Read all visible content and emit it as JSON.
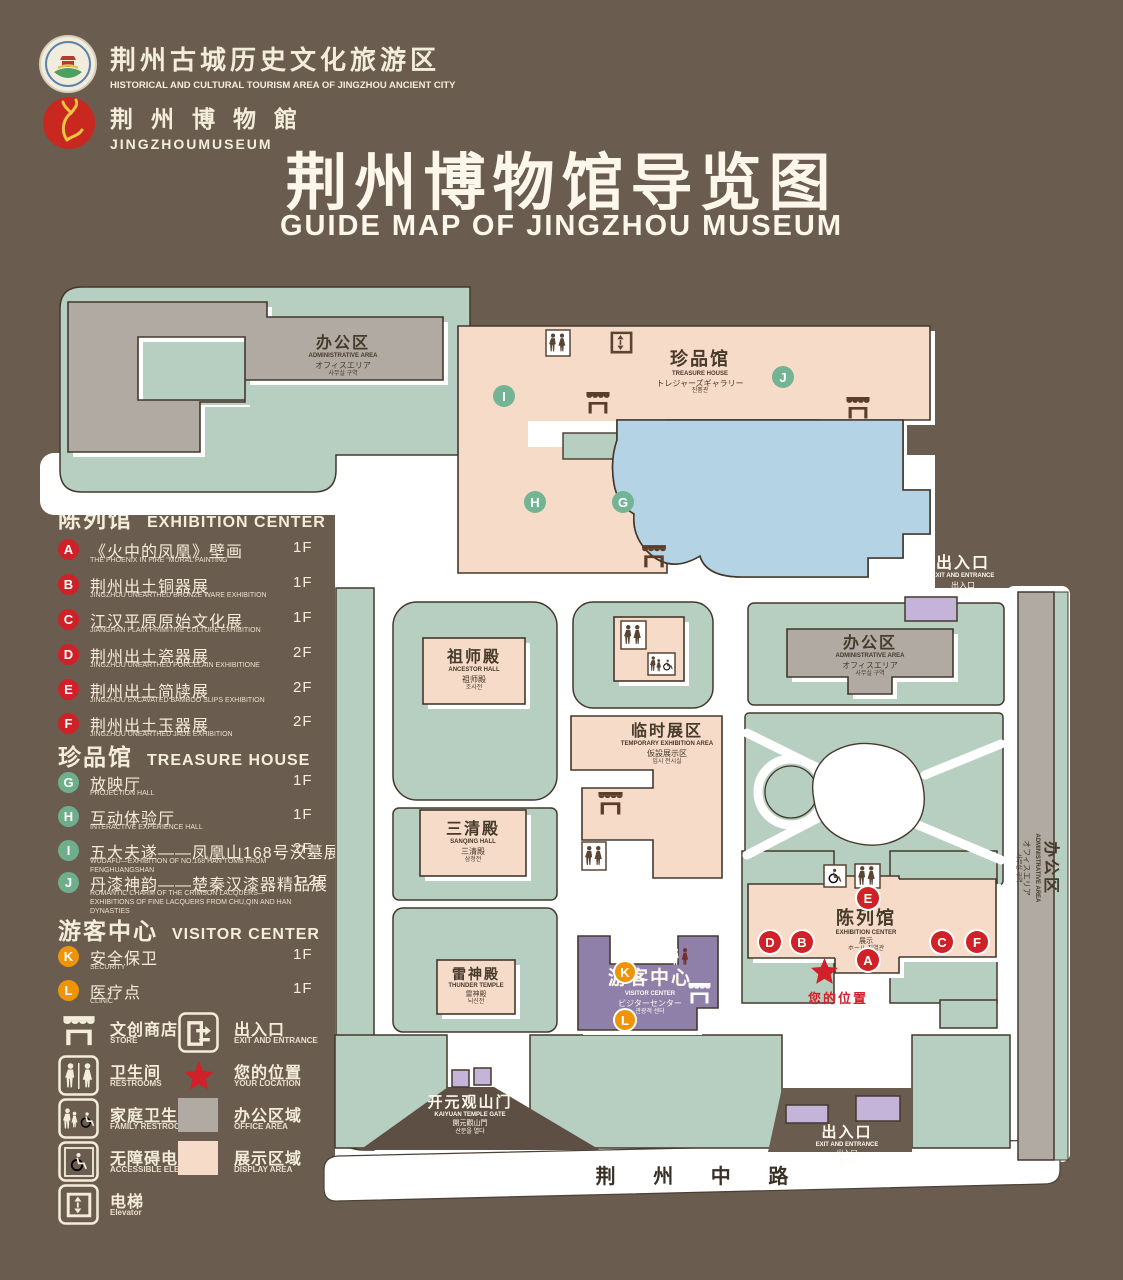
{
  "header": {
    "tourism_logo": {
      "zh": "荆州古城历史文化旅游区",
      "en": "HISTORICAL AND CULTURAL TOURISM AREA OF JINGZHOU ANCIENT CITY"
    },
    "museum_logo": {
      "zh": "荆 州 博 物 館",
      "en": "JINGZHOUMUSEUM"
    },
    "title": "荆州博物馆导览图",
    "subtitle": "GUIDE MAP OF JINGZHOU MUSEUM"
  },
  "legend": {
    "sections": [
      {
        "zh": "陈列馆",
        "en": "EXHIBITION CENTER",
        "items": [
          {
            "key": "A",
            "zh": "《火中的凤凰》壁画",
            "en": "THE PHOENIX IN FIRE \"MURAL PAINTING",
            "floor": "1F"
          },
          {
            "key": "B",
            "zh": "荆州出土铜器展",
            "en": "JINGZHOU UNEARTHED BRONZE WARE EXHIBITION",
            "floor": "1F"
          },
          {
            "key": "C",
            "zh": "江汉平原原始文化展",
            "en": "JIANGHAN PLAIN PRIMITIVE CULTURE EXHIBITION",
            "floor": "1F"
          },
          {
            "key": "D",
            "zh": "荆州出土瓷器展",
            "en": "JINGZHOU UNEARTHED PORCELAIN EXHIBITIONE",
            "floor": "2F"
          },
          {
            "key": "E",
            "zh": "荆州出土简牍展",
            "en": "JINGZHOU EXCAVATED BAMBOO SLIPS EXHIBITION",
            "floor": "2F"
          },
          {
            "key": "F",
            "zh": "荆州出土玉器展",
            "en": "JINGZHOU UNEARTHED JADE EXHIBITION",
            "floor": "2F"
          }
        ]
      },
      {
        "zh": "珍品馆",
        "en": "TREASURE HOUSE",
        "items": [
          {
            "key": "G",
            "zh": "放映厅",
            "en": "PROJECTION HALL",
            "floor": "1F"
          },
          {
            "key": "H",
            "zh": "互动体验厅",
            "en": "INTERACTIVE EXPERIENCE HALL",
            "floor": "1F"
          },
          {
            "key": "I",
            "zh": "五大夫遂——凤凰山168号汉墓展",
            "en": "WUDAFU—EXHIBITION OF NO.168 HAN TOMB FROM FENGHUANGSHAN",
            "floor": "2F"
          },
          {
            "key": "J",
            "zh": "丹漆神韵——楚秦汉漆器精品展",
            "en": "ROMANTIC CHARM OF THE CRIMSON LACQUERS—EXHIBITIONS OF FINE LACQUERS FROM CHU,QIN AND HAN DYNASTIES",
            "floor": "1-2F"
          }
        ]
      },
      {
        "zh": "游客中心",
        "en": "VISITOR CENTER",
        "items": [
          {
            "key": "K",
            "zh": "安全保卫",
            "en": "SECURITY",
            "floor": "1F"
          },
          {
            "key": "L",
            "zh": "医疗点",
            "en": "CLINIC",
            "floor": "1F"
          }
        ]
      }
    ],
    "symbols": [
      {
        "zh": "文创商店",
        "en": "STORE",
        "icon": "store-icon"
      },
      {
        "zh": "出入口",
        "en": "EXIT AND ENTRANCE",
        "icon": "exit-icon"
      },
      {
        "zh": "卫生间",
        "en": "RESTROOMS",
        "icon": "restroom-icon"
      },
      {
        "zh": "您的位置",
        "en": "YOUR LOCATION",
        "icon": "location-star-icon"
      },
      {
        "zh": "家庭卫生间",
        "en": "FAMILY RESTROONS",
        "icon": "family-restroom-icon"
      },
      {
        "zh": "办公区域",
        "en": "OFFICE AREA",
        "icon": "office-area-swatch"
      },
      {
        "zh": "无障碍电梯",
        "en": "ACCESSIBLE ELEVATOR",
        "icon": "accessible-elevator-icon"
      },
      {
        "zh": "展示区域",
        "en": "DISPLAY AREA",
        "icon": "display-area-swatch"
      },
      {
        "zh": "电梯",
        "en": "Elevator",
        "icon": "elevator-icon"
      }
    ]
  },
  "map": {
    "admin": {
      "zh": "办公区",
      "en": "ADMINISTRATIVE AREA",
      "jp": "オフィスエリア",
      "kr": "사무실 구역"
    },
    "treasure": {
      "zh": "珍品馆",
      "en": "TREASURE HOUSE",
      "jp": "トレジャーズギャラリー",
      "kr": "진품관"
    },
    "ancestor": {
      "zh": "祖师殿",
      "en": "ANCESTOR HALL",
      "jp": "祖师殿",
      "kr": "조사전"
    },
    "sanqing": {
      "zh": "三清殿",
      "en": "SANQING HALL",
      "jp": "三清殿",
      "kr": "삼청전"
    },
    "thunder": {
      "zh": "雷神殿",
      "en": "THUNDER TEMPLE",
      "jp": "雷神殿",
      "kr": "뇌신전"
    },
    "temp": {
      "zh": "临时展区",
      "en": "TEMPORARY EXHIBITION AREA",
      "jp": "仮設展示区",
      "kr": "임시 전시실"
    },
    "exhibition": {
      "zh": "陈列馆",
      "en": "EXHIBITION CENTER",
      "jp": "展示",
      "kr": "ホール 진열관"
    },
    "visitor": {
      "zh": "游客中心",
      "en": "VISITOR CENTER",
      "jp": "ビジターセンター",
      "kr": "관광객 센터"
    },
    "entrance": {
      "zh": "出入口",
      "en": "EXIT AND ENTRANCE",
      "jp": "出入口",
      "kr": "출입구"
    },
    "gate": {
      "zh": "开元观山门",
      "en": "KAIYUAN TEMPLE GATE",
      "jp": "開元觀山門",
      "kr": "산문을 열다"
    },
    "road": "荆 州 中 路",
    "your_location": "您的位置",
    "markers": {
      "a": "A",
      "b": "B",
      "c": "C",
      "d": "D",
      "e": "E",
      "f": "F",
      "g": "G",
      "h": "H",
      "i": "I",
      "j": "J",
      "k": "K",
      "l": "L"
    }
  },
  "colors": {
    "background": "#6b5c50",
    "ground": "#ffffff",
    "green_area": "#b7cfc0",
    "display_area": "#f7dbc9",
    "office_area": "#b1aaa2",
    "pond": "#b4d3e4",
    "visitor_purple": "#8e80a8",
    "entrance_purple": "#c5b4da",
    "marker_red": "#cf2127",
    "marker_green": "#72b493",
    "marker_orange": "#ef9408",
    "outline": "#44382c",
    "cream": "#f4edda"
  }
}
